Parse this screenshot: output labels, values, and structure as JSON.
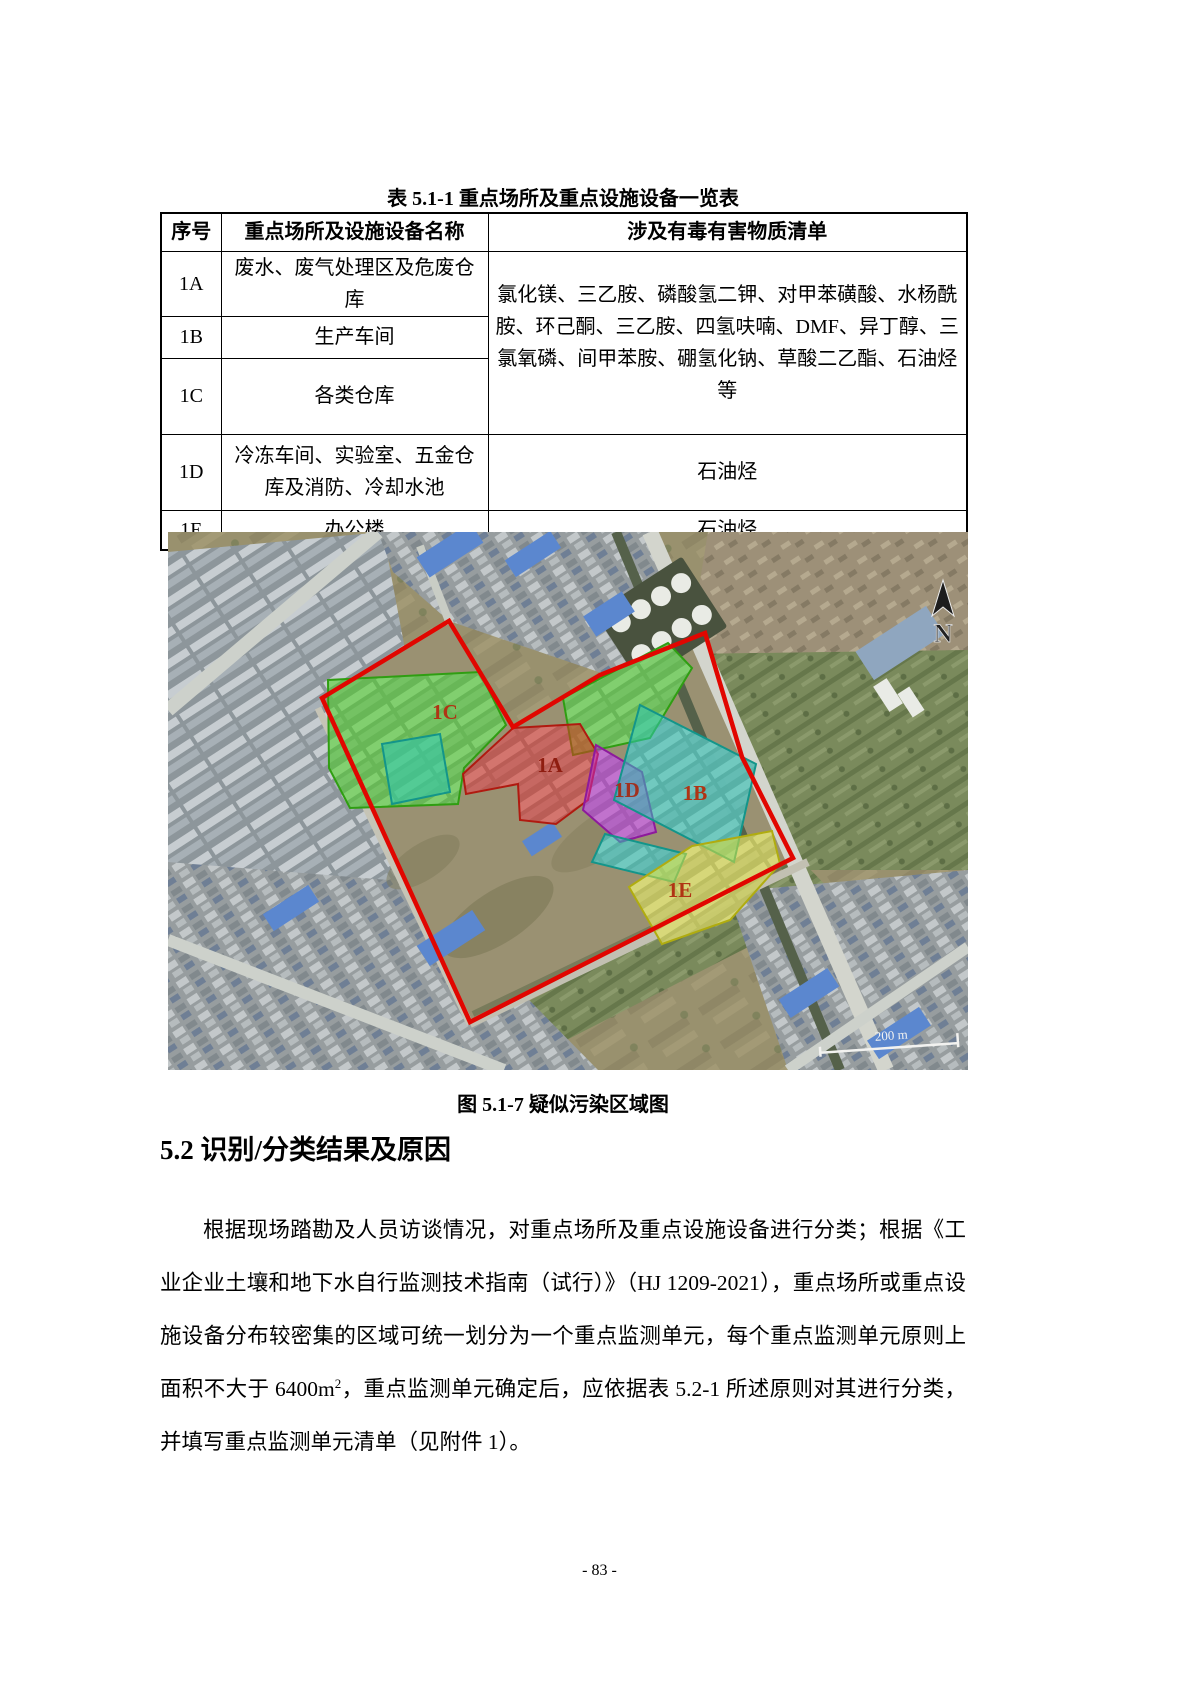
{
  "page": {
    "table_title": "表 5.1-1 重点场所及重点设施设备一览表",
    "figure_caption": "图 5.1-7 疑似污染区域图",
    "section_heading": "5.2 识别/分类结果及原因",
    "paragraph": {
      "before_sup": "根据现场踏勘及人员访谈情况，对重点场所及重点设施设备进行分类；根据《工业企业土壤和地下水自行监测技术指南（试行）》（HJ 1209-2021），重点场所或重点设施设备分布较密集的区域可统一划分为一个重点监测单元，每个重点监测单元原则上面积不大于 6400m",
      "sup": "2",
      "after_sup": "，重点监测单元确定后，应依据表 5.2-1 所述原则对其进行分类，并填写重点监测单元清单（见附件 1）。"
    },
    "page_number": "- 83 -"
  },
  "table": {
    "headers": [
      "序号",
      "重点场所及设施设备名称",
      "涉及有毒有害物质清单"
    ],
    "merged_substances": "氯化镁、三乙胺、磷酸氢二钾、对甲苯磺酸、水杨酰胺、环己酮、三乙胺、四氢呋喃、DMF、异丁醇、三氯氧磷、间甲苯胺、硼氢化钠、草酸二乙酯、石油烃等",
    "rows": [
      {
        "id": "1A",
        "name": "废水、废气处理区及危废仓库"
      },
      {
        "id": "1B",
        "name": "生产车间"
      },
      {
        "id": "1C",
        "name": "各类仓库"
      },
      {
        "id": "1D",
        "name": "冷冻车间、实验室、五金仓库及消防、冷却水池",
        "substances": "石油烃"
      },
      {
        "id": "1E",
        "name": "办公楼",
        "substances": "石油烃"
      }
    ]
  },
  "map": {
    "north_label": "N",
    "scale_label": "200 m",
    "boundary_color": "#e10600",
    "zones": {
      "green": {
        "label": "1C",
        "color": "#4ad422",
        "stroke": "#2f9e12"
      },
      "teal": {
        "label": "1B",
        "color": "#2ec8b4",
        "stroke": "#13958a"
      },
      "red": {
        "label": "1A",
        "color": "#e03020",
        "stroke": "#b01a10"
      },
      "magenta": {
        "label": "1D",
        "color": "#c02ad0",
        "stroke": "#8d1a9c"
      },
      "yellow": {
        "label": "1E",
        "color": "#e6e235",
        "stroke": "#b0ac10"
      }
    }
  }
}
